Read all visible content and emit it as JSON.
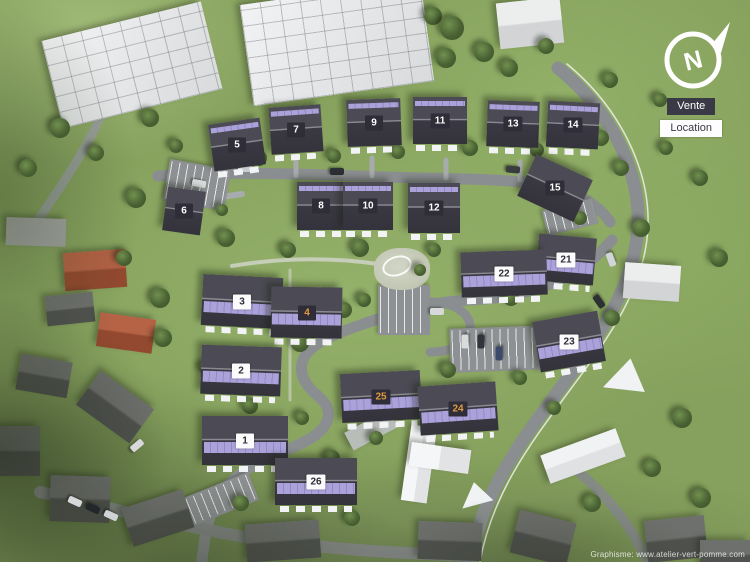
{
  "compass": {
    "letter": "N"
  },
  "legend": {
    "vente": "Vente",
    "location": "Location"
  },
  "credit": "Graphisme: www.atelier-vert-pomme.com",
  "colors": {
    "vente_chip_bg": "#2e2d38",
    "vente_chip_text": "#ffffff",
    "location_chip_bg": "#fbfbfb",
    "location_chip_text": "#2e2d38",
    "reserved_chip_text": "#e09a42",
    "solar_panel": "#aaa2d9",
    "roof_dark": "#3a3943",
    "grass": "#86a15d",
    "road": "#8b8e90"
  },
  "buildings": [
    {
      "num": "5",
      "x": 211,
      "y": 121,
      "w": 52,
      "h": 47,
      "rot": -8,
      "stripe": "thin",
      "chip": "dark",
      "terrace": true
    },
    {
      "num": "7",
      "x": 270,
      "y": 106,
      "w": 52,
      "h": 47,
      "rot": -4,
      "stripe": "thin",
      "chip": "dark",
      "terrace": true
    },
    {
      "num": "9",
      "x": 347,
      "y": 99,
      "w": 54,
      "h": 47,
      "rot": -2,
      "stripe": "thin",
      "chip": "dark",
      "terrace": true
    },
    {
      "num": "11",
      "x": 413,
      "y": 97,
      "w": 54,
      "h": 47,
      "rot": 0,
      "stripe": "thin",
      "chip": "dark",
      "terrace": true
    },
    {
      "num": "13",
      "x": 487,
      "y": 101,
      "w": 52,
      "h": 46,
      "rot": 2,
      "stripe": "thin",
      "chip": "dark",
      "terrace": true
    },
    {
      "num": "14",
      "x": 547,
      "y": 102,
      "w": 52,
      "h": 46,
      "rot": 3,
      "stripe": "thin",
      "chip": "dark",
      "terrace": true
    },
    {
      "num": "6",
      "x": 165,
      "y": 189,
      "w": 38,
      "h": 44,
      "rot": 8,
      "stripe": "none",
      "chip": "dark",
      "terrace": false
    },
    {
      "num": "8",
      "x": 297,
      "y": 182,
      "w": 48,
      "h": 48,
      "rot": 0,
      "stripe": "thin",
      "chip": "dark",
      "terrace": true
    },
    {
      "num": "10",
      "x": 343,
      "y": 182,
      "w": 50,
      "h": 48,
      "rot": 0,
      "stripe": "thin",
      "chip": "dark",
      "terrace": true
    },
    {
      "num": "12",
      "x": 408,
      "y": 183,
      "w": 52,
      "h": 50,
      "rot": 0,
      "stripe": "thin",
      "chip": "dark",
      "terrace": true
    },
    {
      "num": "15",
      "x": 524,
      "y": 165,
      "w": 62,
      "h": 46,
      "rot": 25,
      "stripe": "none",
      "chip": "dark",
      "terrace": false
    },
    {
      "num": "21",
      "x": 537,
      "y": 236,
      "w": 58,
      "h": 47,
      "rot": 5,
      "stripe": "thick",
      "chip": "light",
      "terrace": true
    },
    {
      "num": "22",
      "x": 461,
      "y": 251,
      "w": 86,
      "h": 45,
      "rot": -2,
      "stripe": "thick",
      "chip": "light",
      "terrace": true
    },
    {
      "num": "3",
      "x": 202,
      "y": 276,
      "w": 80,
      "h": 51,
      "rot": 3,
      "stripe": "thick",
      "chip": "light",
      "terrace": true
    },
    {
      "num": "4",
      "x": 271,
      "y": 287,
      "w": 71,
      "h": 51,
      "rot": 1,
      "stripe": "thick",
      "chip": "reserved",
      "terrace": true
    },
    {
      "num": "23",
      "x": 536,
      "y": 316,
      "w": 66,
      "h": 51,
      "rot": -10,
      "stripe": "thick",
      "chip": "light",
      "terrace": true
    },
    {
      "num": "2",
      "x": 201,
      "y": 346,
      "w": 80,
      "h": 49,
      "rot": 2,
      "stripe": "thick",
      "chip": "light",
      "terrace": true
    },
    {
      "num": "25",
      "x": 341,
      "y": 372,
      "w": 80,
      "h": 49,
      "rot": -3,
      "stripe": "thick",
      "chip": "reserved",
      "terrace": true
    },
    {
      "num": "24",
      "x": 419,
      "y": 384,
      "w": 78,
      "h": 49,
      "rot": -4,
      "stripe": "thick",
      "chip": "reserved",
      "terrace": true
    },
    {
      "num": "1",
      "x": 202,
      "y": 416,
      "w": 86,
      "h": 49,
      "rot": 0,
      "stripe": "thick",
      "chip": "light",
      "terrace": true
    },
    {
      "num": "26",
      "x": 275,
      "y": 458,
      "w": 82,
      "h": 47,
      "rot": 0,
      "stripe": "thick",
      "chip": "light",
      "terrace": true
    }
  ],
  "roads": [
    {
      "n": "road-east-main",
      "d": "M 558,68 C 608,108 640,168 638,224 C 636,282 602,332 562,386 C 522,440 482,492 470,562",
      "w": 13,
      "c": "#8b8e90"
    },
    {
      "n": "road-east-edge-line",
      "d": "M 567,64 C 618,106 650,168 648,226 C 646,286 610,336 570,390 C 530,444 492,494 480,562",
      "w": 1.5,
      "c": "#eef0ec",
      "o": 0.85
    },
    {
      "n": "road-north-street",
      "d": "M 158,176 C 250,170 340,176 420,178 C 480,179 520,180 548,186 C 576,192 598,204 610,222",
      "w": 11,
      "c": "#8b8e90"
    },
    {
      "n": "road-serpentine",
      "d": "M 612,240 C 574,284 520,298 470,300 C 424,302 386,316 352,328 C 314,342 298,354 302,374 C 308,396 332,398 328,418 C 322,442 284,448 252,466 C 224,482 208,508 204,545 C 203,552 202,557 202,562",
      "w": 11,
      "c": "#8b8e90"
    },
    {
      "n": "road-central-loop",
      "d": "M 428,302 C 458,302 472,316 470,330 C 468,344 452,352 430,352",
      "w": 9,
      "c": "#8b8e90"
    },
    {
      "n": "road-west-old",
      "d": "M 28,234 C 58,192 84,152 98,122 C 106,104 116,90 126,80",
      "w": 9,
      "c": "#9a9e9f",
      "o": 0.9
    },
    {
      "n": "road-bottom-street",
      "d": "M 40,492 C 110,508 180,526 250,538 C 330,550 400,553 470,556",
      "w": 12,
      "c": "#85888a",
      "o": 0.92
    },
    {
      "n": "road-bottom-right",
      "d": "M 648,562 C 630,524 606,494 576,470",
      "w": 10,
      "c": "#85888a",
      "o": 0.9
    },
    {
      "n": "path-playground",
      "d": "M 232,266 C 290,256 344,258 392,266",
      "w": 4,
      "c": "#d3d6cd",
      "o": 0.8
    },
    {
      "n": "path-west-walk",
      "d": "M 290,270 L 290,400",
      "w": 3,
      "c": "#d3d6cd",
      "o": 0.6
    },
    {
      "n": "driveway-7",
      "d": "M 296,176 L 296,158",
      "w": 5,
      "c": "#a8abad"
    },
    {
      "n": "driveway-9",
      "d": "M 372,176 L 372,158",
      "w": 5,
      "c": "#a8abad"
    },
    {
      "n": "driveway-11",
      "d": "M 446,178 L 446,160",
      "w": 5,
      "c": "#a8abad"
    },
    {
      "n": "driveway-13",
      "d": "M 520,180 L 520,162",
      "w": 5,
      "c": "#a8abad"
    },
    {
      "n": "driveway-6",
      "d": "M 202,200 L 242,194",
      "w": 6,
      "c": "#a8abad"
    }
  ],
  "parking_lots": [
    [
      166,
      164,
      62,
      42,
      10
    ],
    [
      544,
      204,
      52,
      26,
      -14
    ],
    [
      378,
      285,
      52,
      50,
      0
    ],
    [
      450,
      327,
      98,
      44,
      -2
    ],
    [
      186,
      484,
      70,
      30,
      -22
    ]
  ],
  "context": [
    {
      "t": "white-block",
      "x": 50,
      "y": 20,
      "w": 164,
      "h": 90,
      "r": -14
    },
    {
      "t": "white-block",
      "x": 246,
      "y": -8,
      "w": 182,
      "h": 102,
      "r": -8
    },
    {
      "t": "white-house",
      "x": 498,
      "y": 0,
      "w": 64,
      "h": 46,
      "r": -6
    },
    {
      "t": "gray-flat",
      "x": 6,
      "y": 218,
      "w": 60,
      "h": 28,
      "r": 2
    },
    {
      "t": "red-house",
      "x": 64,
      "y": 251,
      "w": 62,
      "h": 38,
      "r": -4
    },
    {
      "t": "gray-house",
      "x": 46,
      "y": 294,
      "w": 48,
      "h": 30,
      "r": -6
    },
    {
      "t": "red-house",
      "x": 98,
      "y": 316,
      "w": 56,
      "h": 34,
      "r": 8
    },
    {
      "t": "gray-house",
      "x": 18,
      "y": 358,
      "w": 52,
      "h": 36,
      "r": 10
    },
    {
      "t": "white-house",
      "x": 624,
      "y": 264,
      "w": 56,
      "h": 36,
      "r": 4
    },
    {
      "t": "gray-house",
      "x": 82,
      "y": 386,
      "w": 66,
      "h": 42,
      "r": 36
    },
    {
      "t": "gray-house",
      "x": -6,
      "y": 426,
      "w": 46,
      "h": 50,
      "r": 0
    },
    {
      "t": "gray-house",
      "x": 50,
      "y": 476,
      "w": 60,
      "h": 46,
      "r": 2
    },
    {
      "t": "gray-house",
      "x": 126,
      "y": 498,
      "w": 64,
      "h": 40,
      "r": -18
    },
    {
      "t": "gray-house",
      "x": 246,
      "y": 522,
      "w": 74,
      "h": 38,
      "r": -4
    },
    {
      "t": "gray-house",
      "x": 418,
      "y": 522,
      "w": 64,
      "h": 38,
      "r": 2
    },
    {
      "t": "gray-house",
      "x": 514,
      "y": 516,
      "w": 58,
      "h": 44,
      "r": 14
    },
    {
      "t": "gray-house",
      "x": 646,
      "y": 518,
      "w": 60,
      "h": 42,
      "r": -6
    },
    {
      "t": "gray-house",
      "x": 700,
      "y": 540,
      "w": 50,
      "h": 30,
      "r": 0
    },
    {
      "t": "white-barn",
      "x": 543,
      "y": 441,
      "w": 80,
      "h": 30,
      "r": -20
    },
    {
      "t": "white-cross-v",
      "x": 406,
      "y": 426,
      "w": 26,
      "h": 76,
      "r": 8
    },
    {
      "t": "white-cross-h",
      "x": 410,
      "y": 446,
      "w": 60,
      "h": 24,
      "r": 8
    },
    {
      "t": "gray-roof",
      "x": 346,
      "y": 420,
      "w": 50,
      "h": 20,
      "r": -28
    },
    {
      "t": "white-canopy",
      "x": 606,
      "y": 358,
      "w": 42,
      "h": 34,
      "r": 12
    },
    {
      "t": "white-canopy",
      "x": 460,
      "y": 482,
      "w": 32,
      "h": 24,
      "r": -10
    }
  ],
  "playground": {
    "x": 374,
    "y": 248,
    "w": 56,
    "h": 42
  },
  "trees": [
    [
      150,
      118,
      9
    ],
    [
      176,
      146,
      7
    ],
    [
      259,
      158,
      8
    ],
    [
      334,
      156,
      7
    ],
    [
      398,
      152,
      7
    ],
    [
      470,
      148,
      8
    ],
    [
      537,
      150,
      7
    ],
    [
      601,
      138,
      8
    ],
    [
      136,
      198,
      10
    ],
    [
      124,
      258,
      8
    ],
    [
      160,
      298,
      10
    ],
    [
      163,
      338,
      9
    ],
    [
      205,
      368,
      6
    ],
    [
      226,
      238,
      9
    ],
    [
      288,
      250,
      8
    ],
    [
      360,
      248,
      9
    ],
    [
      434,
      250,
      7
    ],
    [
      511,
      298,
      8
    ],
    [
      300,
      343,
      9
    ],
    [
      344,
      310,
      8
    ],
    [
      250,
      406,
      8
    ],
    [
      302,
      418,
      7
    ],
    [
      448,
      370,
      8
    ],
    [
      520,
      378,
      7
    ],
    [
      612,
      318,
      8
    ],
    [
      641,
      228,
      9
    ],
    [
      621,
      168,
      8
    ],
    [
      666,
      148,
      7
    ],
    [
      433,
      16,
      9
    ],
    [
      452,
      28,
      12
    ],
    [
      484,
      52,
      10
    ],
    [
      509,
      68,
      9
    ],
    [
      446,
      58,
      10
    ],
    [
      546,
      46,
      8
    ],
    [
      700,
      178,
      8
    ],
    [
      719,
      258,
      9
    ],
    [
      682,
      418,
      10
    ],
    [
      652,
      468,
      9
    ],
    [
      701,
      498,
      10
    ],
    [
      592,
      503,
      9
    ],
    [
      241,
      503,
      8
    ],
    [
      352,
      518,
      8
    ],
    [
      60,
      128,
      10
    ],
    [
      28,
      168,
      9
    ],
    [
      96,
      153,
      8
    ],
    [
      376,
      438,
      7
    ],
    [
      332,
      458,
      8
    ],
    [
      476,
      418,
      7
    ],
    [
      554,
      408,
      7
    ],
    [
      364,
      300,
      7
    ],
    [
      420,
      270,
      6
    ],
    [
      222,
      210,
      6
    ],
    [
      580,
      218,
      7
    ],
    [
      610,
      80,
      8
    ],
    [
      660,
      100,
      7
    ]
  ],
  "cars": [
    [
      604,
      256,
      70,
      "#d2d5d7"
    ],
    [
      592,
      298,
      55,
      "#2e3134"
    ],
    [
      506,
      166,
      5,
      "#3a3d40"
    ],
    [
      192,
      180,
      10,
      "#d8dadc"
    ],
    [
      458,
      338,
      90,
      "#d8dadc"
    ],
    [
      474,
      338,
      90,
      "#30343a"
    ],
    [
      492,
      350,
      90,
      "#3b4a6b"
    ],
    [
      430,
      308,
      0,
      "#d6d8da"
    ],
    [
      68,
      498,
      24,
      "#d6d8da"
    ],
    [
      86,
      505,
      24,
      "#23262a"
    ],
    [
      104,
      512,
      24,
      "#cfd3d6"
    ],
    [
      130,
      442,
      -40,
      "#d6d8da"
    ],
    [
      238,
      165,
      0,
      "#caccce"
    ],
    [
      330,
      168,
      0,
      "#2c2f33"
    ]
  ]
}
